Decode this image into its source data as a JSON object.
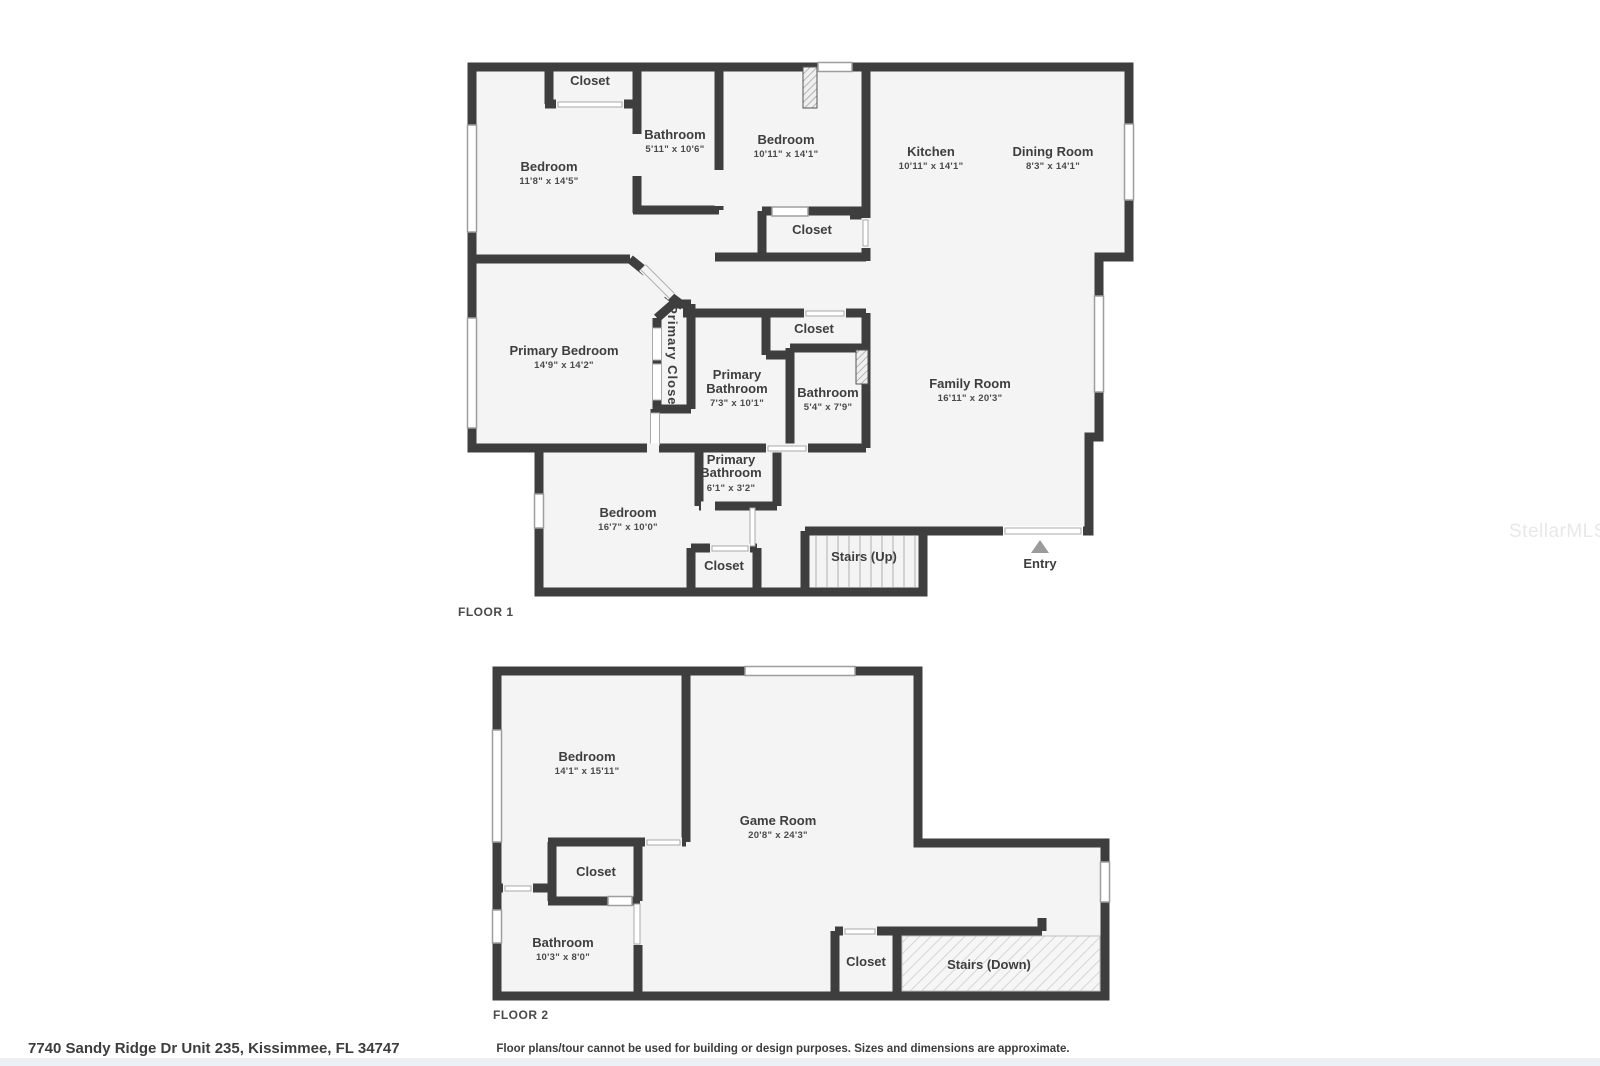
{
  "watermark": "StellarMLS",
  "address": "7740 Sandy Ridge Dr Unit 235, Kissimmee, FL 34747",
  "disclaimer": "Floor plans/tour cannot be used for building or design purposes. Sizes and dimensions are approximate.",
  "colors": {
    "wall": "#3e3e3e",
    "room_fill": "#f4f4f4",
    "label": "#3f3f3f",
    "window_stroke": "#9e9e9e",
    "entry_arrow": "#9b9b9b",
    "watermark": "#e8e8e8",
    "footer_strip": "#edf1f5"
  },
  "floor1": {
    "label": "FLOOR 1",
    "rooms": [
      {
        "id": "closet-top-left",
        "name_lines": [
          "Closet"
        ],
        "dims": ""
      },
      {
        "id": "bedroom-1",
        "name_lines": [
          "Bedroom"
        ],
        "dims": "11'8\" x 14'5\""
      },
      {
        "id": "bathroom-1",
        "name_lines": [
          "Bathroom"
        ],
        "dims": "5'11\" x 10'6\""
      },
      {
        "id": "bedroom-2",
        "name_lines": [
          "Bedroom"
        ],
        "dims": "10'11\" x 14'1\""
      },
      {
        "id": "kitchen",
        "name_lines": [
          "Kitchen"
        ],
        "dims": "10'11\" x 14'1\""
      },
      {
        "id": "dining-room",
        "name_lines": [
          "Dining Room"
        ],
        "dims": "8'3\" x 14'1\""
      },
      {
        "id": "closet-bedroom-2",
        "name_lines": [
          "Closet"
        ],
        "dims": ""
      },
      {
        "id": "primary-bedroom",
        "name_lines": [
          "Primary Bedroom"
        ],
        "dims": "14'9\" x 14'2\""
      },
      {
        "id": "primary-closet",
        "name_lines": [
          "Primary Closet"
        ],
        "dims": ""
      },
      {
        "id": "closet-hall",
        "name_lines": [
          "Closet"
        ],
        "dims": ""
      },
      {
        "id": "primary-bathroom",
        "name_lines": [
          "Primary",
          "Bathroom"
        ],
        "dims": "7'3\" x 10'1\""
      },
      {
        "id": "bathroom-2",
        "name_lines": [
          "Bathroom"
        ],
        "dims": "5'4\" x 7'9\""
      },
      {
        "id": "family-room",
        "name_lines": [
          "Family Room"
        ],
        "dims": "16'11\" x 20'3\""
      },
      {
        "id": "primary-bathroom-2",
        "name_lines": [
          "Primary",
          "Bathroom"
        ],
        "dims": "6'1\" x 3'2\""
      },
      {
        "id": "bedroom-3",
        "name_lines": [
          "Bedroom"
        ],
        "dims": "16'7\" x 10'0\""
      },
      {
        "id": "closet-bedroom-3",
        "name_lines": [
          "Closet"
        ],
        "dims": ""
      },
      {
        "id": "stairs-up",
        "name_lines": [
          "Stairs (Up)"
        ],
        "dims": ""
      },
      {
        "id": "entry",
        "name_lines": [
          "Entry"
        ],
        "dims": ""
      }
    ]
  },
  "floor2": {
    "label": "FLOOR 2",
    "rooms": [
      {
        "id": "bedroom",
        "name_lines": [
          "Bedroom"
        ],
        "dims": "14'1\" x 15'11\""
      },
      {
        "id": "game-room",
        "name_lines": [
          "Game Room"
        ],
        "dims": "20'8\" x 24'3\""
      },
      {
        "id": "closet-bedroom",
        "name_lines": [
          "Closet"
        ],
        "dims": ""
      },
      {
        "id": "bathroom",
        "name_lines": [
          "Bathroom"
        ],
        "dims": "10'3\" x 8'0\""
      },
      {
        "id": "closet-hall",
        "name_lines": [
          "Closet"
        ],
        "dims": ""
      },
      {
        "id": "stairs-down",
        "name_lines": [
          "Stairs (Down)"
        ],
        "dims": ""
      }
    ]
  }
}
